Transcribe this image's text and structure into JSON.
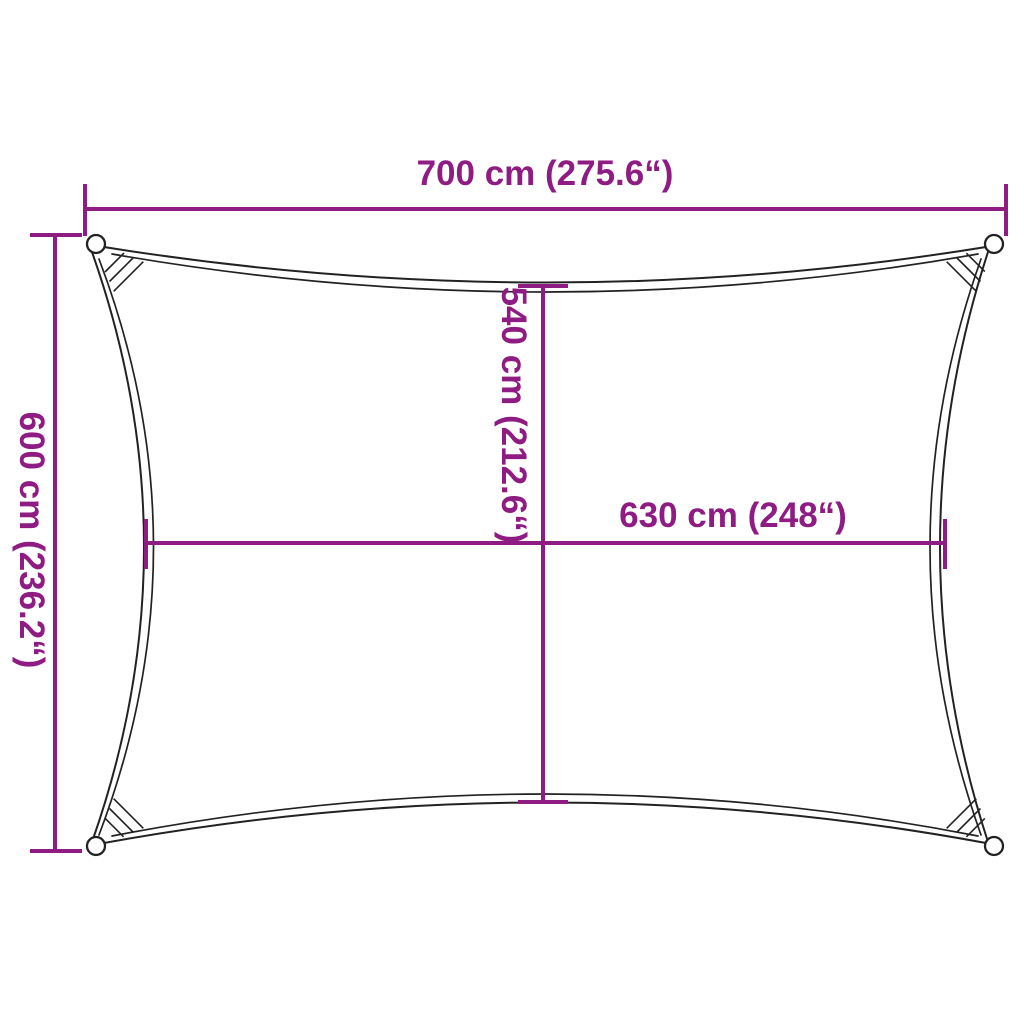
{
  "diagram": {
    "product": "rectangular-shade-sail-dimension-diagram",
    "colors": {
      "dimension_color": "#8E1C82",
      "outline_color": "#222222",
      "background": "#ffffff"
    },
    "dimensions": {
      "width": {
        "label": "700 cm (275.6“)",
        "cm": 700,
        "inches": 275.6,
        "position": "top"
      },
      "height": {
        "label": "600 cm (236.2“)",
        "cm": 600,
        "inches": 236.2,
        "position": "left"
      },
      "inner_height": {
        "label": "540 cm (212.6“)",
        "cm": 540,
        "inches": 212.6,
        "position": "center-vertical"
      },
      "inner_width": {
        "label": "630 cm (248“)",
        "cm": 630,
        "inches": 248,
        "position": "center-horizontal"
      }
    }
  }
}
